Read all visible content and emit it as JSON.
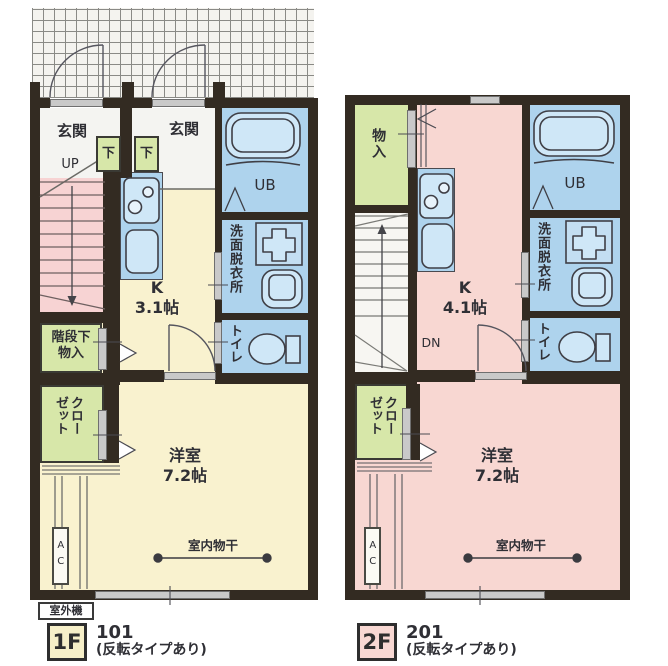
{
  "floorplan": {
    "colors": {
      "wall": "#332b22",
      "floor1_room": "#f9f2cf",
      "floor2_room": "#f8d7d2",
      "wet_room_blue": "#aed3ed",
      "fixture_blue": "#cfe7f7",
      "storage_green": "#d7e7a9",
      "stair1_pink": "#f7d3d3",
      "badge1_bg": "#f6efc8",
      "badge2_bg": "#f8d8d3"
    },
    "floor1": {
      "badge": "1F",
      "unit_no": "101",
      "unit_note": "(反転タイプあり)",
      "outdoor_unit": "室外機",
      "labels": {
        "genkan_left": "玄関",
        "genkan_right": "玄関",
        "step_left": "下",
        "step_right": "下",
        "up": "UP",
        "kitchen": "K\n3.1帖",
        "ub": "UB",
        "washroom": "洗面脱衣所",
        "toilet": "トイレ",
        "understair": "階段下\n物入",
        "closet": "クロー\nゼット",
        "bedroom": "洋室\n7.2帖",
        "drying": "室内物干",
        "ac": "AC"
      }
    },
    "floor2": {
      "badge": "2F",
      "unit_no": "201",
      "unit_note": "(反転タイプあり)",
      "labels": {
        "storage": "物入",
        "dn": "DN",
        "kitchen": "K\n4.1帖",
        "ub": "UB",
        "washroom": "洗面脱衣所",
        "toilet": "トイレ",
        "closet": "クロー\nゼット",
        "bedroom": "洋室\n7.2帖",
        "drying": "室内物干",
        "ac": "AC"
      }
    }
  }
}
